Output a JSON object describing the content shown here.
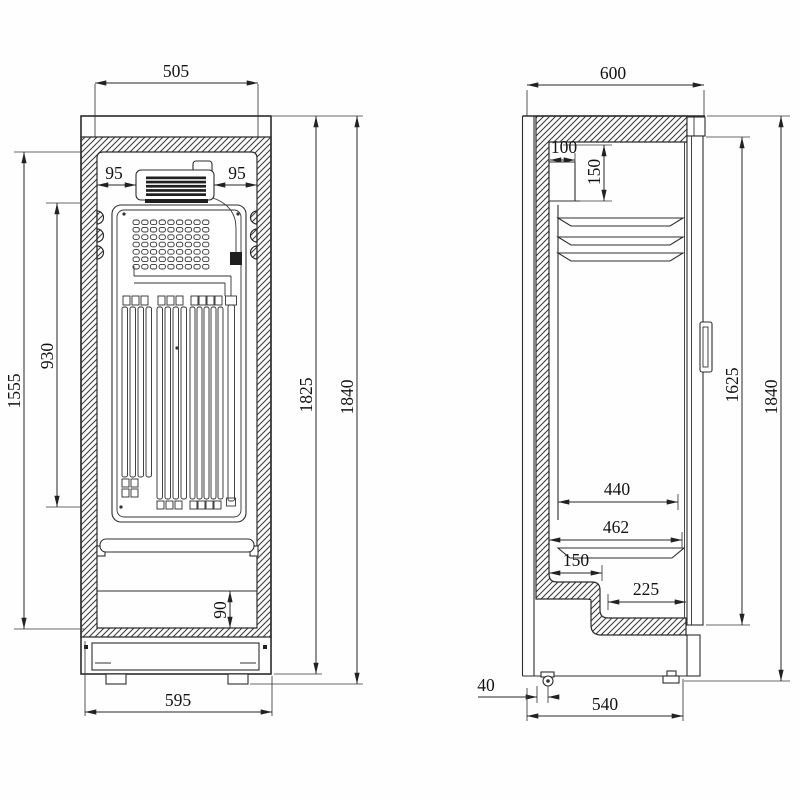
{
  "drawing": {
    "rear_view": {
      "dims": {
        "top_width": "505",
        "vent_gap_left": "95",
        "vent_gap_right": "95",
        "condenser_length": "930",
        "inner_height": "1555",
        "body_height": "1825",
        "total_height": "1840",
        "lower_panel_height": "90",
        "base_width": "595"
      }
    },
    "side_view": {
      "dims": {
        "depth": "600",
        "evaporator_width": "100",
        "evaporator_height": "150",
        "door_height": "1625",
        "total_height": "1840",
        "shelf_depth": "440",
        "interior_depth": "462",
        "step_width": "150",
        "recess_width": "225",
        "rear_offset": "40",
        "base_depth": "540"
      }
    }
  }
}
